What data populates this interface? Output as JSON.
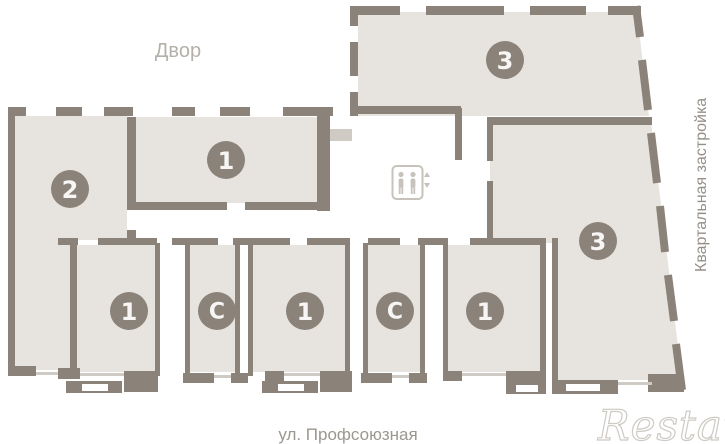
{
  "plan": {
    "labels": {
      "yard": "Двор",
      "street": "ул. Профсоюзная",
      "side": "Квартальная застройка"
    },
    "watermark": "Restate",
    "units": [
      {
        "id": "unit-2-left",
        "label": "2"
      },
      {
        "id": "unit-1-top",
        "label": "1"
      },
      {
        "id": "unit-3-top",
        "label": "3"
      },
      {
        "id": "unit-1-bottom-1",
        "label": "1"
      },
      {
        "id": "unit-c-bottom-1",
        "label": "С"
      },
      {
        "id": "unit-1-bottom-2",
        "label": "1"
      },
      {
        "id": "unit-c-bottom-2",
        "label": "С"
      },
      {
        "id": "unit-1-bottom-3",
        "label": "1"
      },
      {
        "id": "unit-3-right",
        "label": "3"
      }
    ],
    "icons": [
      {
        "name": "elevator-icon"
      }
    ],
    "colors": {
      "wall": "#8b8379",
      "room_fill": "#e7e4e0",
      "badge": "#8b8379",
      "badge_text": "#f7f6f4",
      "label_light": "#b4b0aa",
      "label_medium": "#9c978f",
      "side_label": "#948f88",
      "watermark": "#cecac4",
      "sill": "#cfcbc4",
      "icon": "#c7c3bc"
    }
  }
}
